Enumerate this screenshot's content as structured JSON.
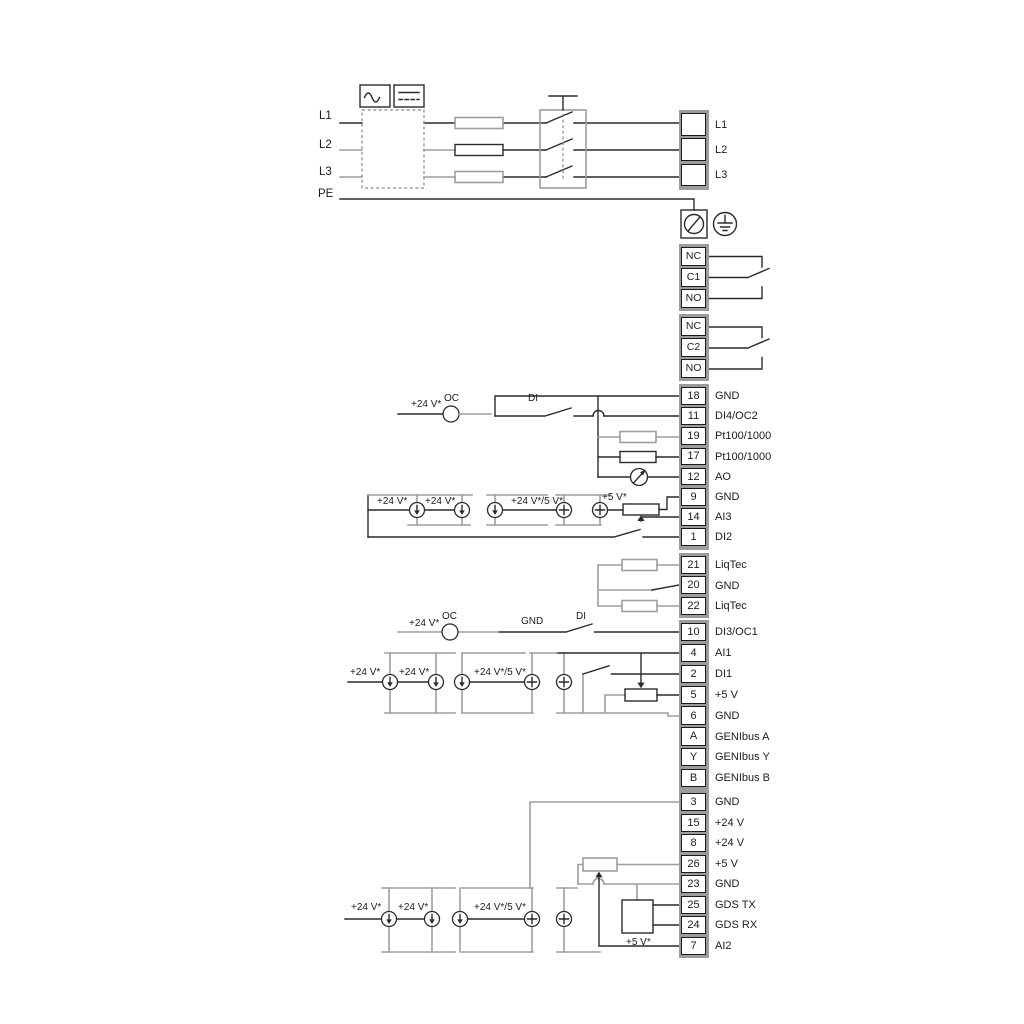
{
  "power": {
    "phase_in": [
      "L1",
      "L2",
      "L3"
    ],
    "pe_label": "PE",
    "phase_out": [
      "L1",
      "L2",
      "L3"
    ]
  },
  "relay1": {
    "rows": [
      "NC",
      "C1",
      "NO"
    ]
  },
  "relay2": {
    "rows": [
      "NC",
      "C2",
      "NO"
    ]
  },
  "groups": {
    "a": {
      "rows": [
        {
          "num": "18",
          "label": "GND"
        },
        {
          "num": "11",
          "label": "DI4/OC2"
        },
        {
          "num": "19",
          "label": "Pt100/1000"
        },
        {
          "num": "17",
          "label": "Pt100/1000"
        },
        {
          "num": "12",
          "label": "AO"
        },
        {
          "num": "9",
          "label": "GND"
        },
        {
          "num": "14",
          "label": "AI3"
        },
        {
          "num": "1",
          "label": "DI2"
        }
      ]
    },
    "b": {
      "rows": [
        {
          "num": "21",
          "label": "LiqTec"
        },
        {
          "num": "20",
          "label": "GND"
        },
        {
          "num": "22",
          "label": "LiqTec"
        }
      ]
    },
    "c": {
      "rows": [
        {
          "num": "10",
          "label": "DI3/OC1"
        },
        {
          "num": "4",
          "label": "AI1"
        },
        {
          "num": "2",
          "label": "DI1"
        },
        {
          "num": "5",
          "label": "+5 V"
        },
        {
          "num": "6",
          "label": "GND"
        },
        {
          "num": "A",
          "label": "GENIbus A"
        },
        {
          "num": "Y",
          "label": "GENIbus Y"
        },
        {
          "num": "B",
          "label": "GENIbus B"
        }
      ]
    },
    "e": {
      "rows": [
        {
          "num": "3",
          "label": "GND"
        },
        {
          "num": "15",
          "label": "+24 V"
        },
        {
          "num": "8",
          "label": "+24 V"
        },
        {
          "num": "26",
          "label": "+5 V"
        },
        {
          "num": "23",
          "label": "GND"
        },
        {
          "num": "25",
          "label": "GDS TX"
        },
        {
          "num": "24",
          "label": "GDS RX"
        },
        {
          "num": "7",
          "label": "AI2"
        }
      ]
    }
  },
  "ann": {
    "v24": "+24 V*",
    "v24v5": "+24 V*/5 V*",
    "v5": "+5 V*",
    "oc": "OC",
    "di": "DI",
    "gnd": "GND"
  }
}
